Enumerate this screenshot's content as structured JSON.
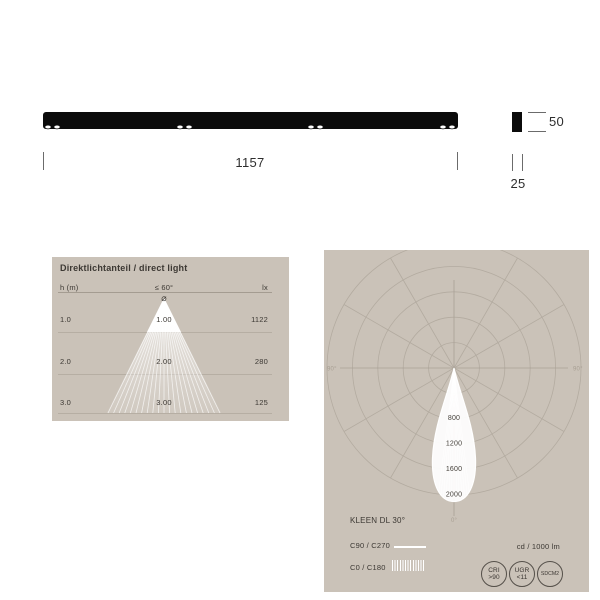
{
  "fixture": {
    "length_label": "1157",
    "height_label": "50",
    "width_label": "25"
  },
  "direct_light": {
    "title": "Direktlichtanteil / direct light",
    "columns": {
      "height": "h (m)",
      "beam_angle": "≤ 60°",
      "illuminance": "lx"
    },
    "diameter_symbol": "⌀",
    "rows": [
      {
        "h": "1.0",
        "diameter": "1.00",
        "lx": "1122"
      },
      {
        "h": "2.0",
        "diameter": "2.00",
        "lx": "280"
      },
      {
        "h": "3.0",
        "diameter": "3.00",
        "lx": "125"
      }
    ]
  },
  "polar": {
    "title": "KLEEN DL 30°",
    "legend": [
      {
        "label": "C90 / C270",
        "style": "solid"
      },
      {
        "label": "C0 / C180",
        "style": "hatched"
      }
    ],
    "unit": "cd / 1000 lm",
    "ring_labels": [
      "800",
      "1200",
      "1600",
      "2000"
    ],
    "axis": {
      "left": "90°",
      "right": "90°",
      "bottom": "0°"
    },
    "badges": [
      {
        "line1": "CRI",
        "line2": ">90"
      },
      {
        "line1": "UGR",
        "line2": "<11"
      },
      {
        "line1": "SDCM2",
        "line2": ""
      }
    ]
  },
  "colors": {
    "panel_bg": "#cac2b8",
    "grid": "#b3aba0",
    "text_dark": "#3c3833",
    "beam_white": "#ffffff",
    "fixture_black": "#0b0b0b"
  }
}
